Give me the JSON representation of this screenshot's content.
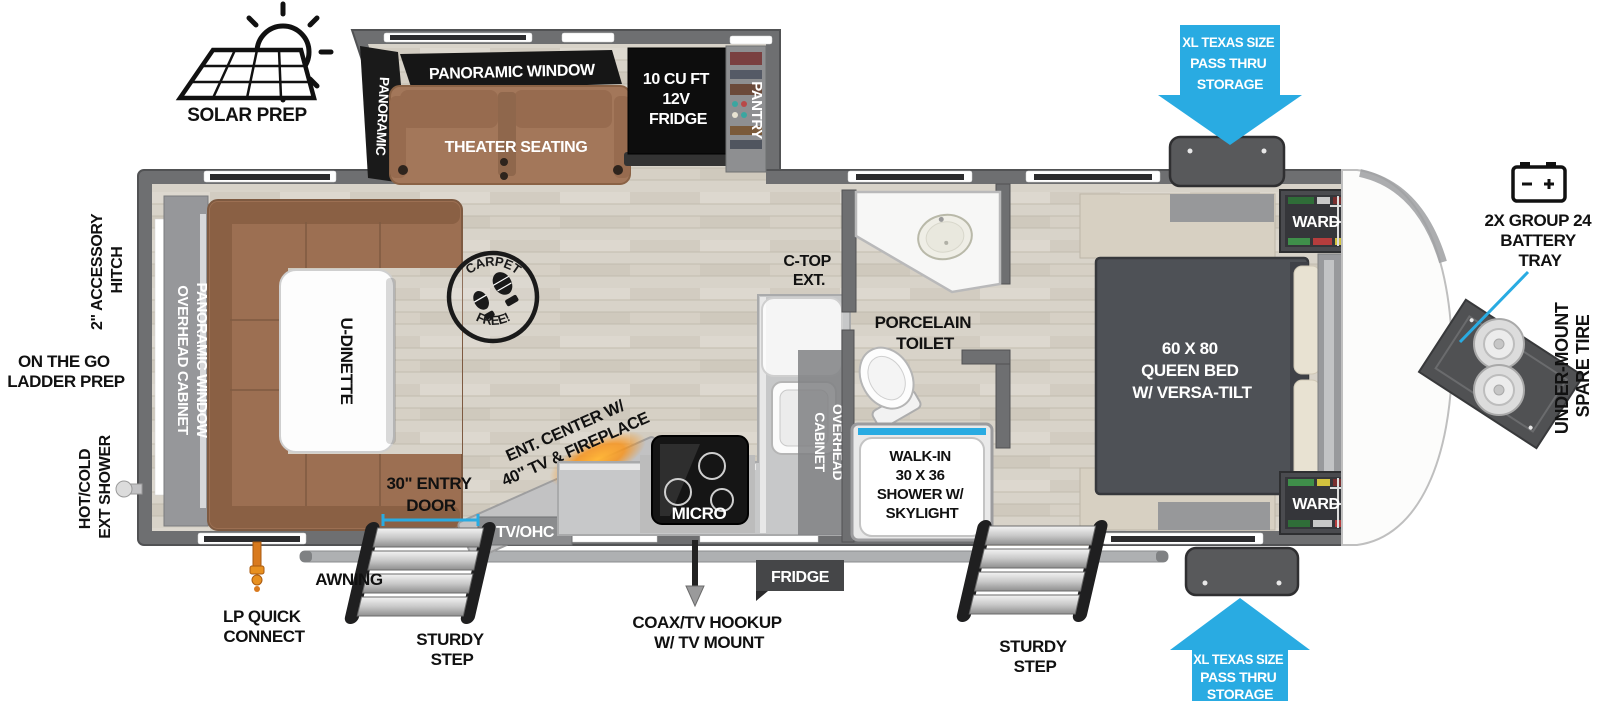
{
  "colors": {
    "accent_blue": "#29ABE2",
    "wall_gray": "#6E6F71",
    "sofa_brown": "#A3775A",
    "bed_gray": "#4E5156",
    "fireplace_orange": "#F7941D",
    "panel_black": "#111111"
  },
  "exterior": {
    "solar_prep_label": "SOLAR PREP",
    "pass_thru_top": [
      "XL TEXAS SIZE",
      "PASS THRU",
      "STORAGE"
    ],
    "pass_thru_bottom": [
      "XL TEXAS SIZE",
      "PASS THRU",
      "STORAGE"
    ],
    "battery_tray": [
      "2X GROUP 24",
      "BATTERY",
      "TRAY"
    ],
    "spare_tire": [
      "UNDER-MOUNT",
      "SPARE TIRE"
    ],
    "accessory_hitch": [
      "2\" ACCESSORY",
      "HITCH"
    ],
    "ladder_prep": [
      "ON THE GO",
      "LADDER PREP"
    ],
    "ext_shower": [
      "HOT/COLD",
      "EXT SHOWER"
    ],
    "lp_quick_connect": [
      "LP QUICK",
      "CONNECT"
    ],
    "awning": "AWNING",
    "sturdy_step_left": [
      "STURDY",
      "STEP"
    ],
    "sturdy_step_right": [
      "STURDY",
      "STEP"
    ],
    "coax_tv": [
      "COAX/TV HOOKUP",
      "W/ TV MOUNT"
    ],
    "fridge_exterior": "FRIDGE",
    "entry_door": [
      "30\" ENTRY",
      "DOOR"
    ]
  },
  "living_area": {
    "panoramic_window_angled": [
      "PANORAMIC",
      "WINDOW"
    ],
    "panoramic_window_banner": "PANORAMIC WINDOW",
    "theater_seating": "THEATER SEATING",
    "fridge_12v": [
      "10 CU FT",
      "12V",
      "FRIDGE"
    ],
    "pantry": "PANTRY",
    "overhead_cabinet_wall": "OVERHEAD CABINET",
    "panoramic_window_wall": "PANORAMIC WINDOW",
    "u_dinette": "U-DINETTE",
    "carpet_free": [
      "CARPET",
      "FREE!"
    ],
    "ent_center": [
      "ENT. CENTER W/",
      "40\" TV & FIREPLACE"
    ],
    "tv_ohc": "TV/OHC"
  },
  "kitchen": {
    "ctop_ext": [
      "C-TOP",
      "EXT."
    ],
    "overhead_cabinet": [
      "OVERHEAD",
      "CABINET"
    ],
    "micro": "MICRO"
  },
  "bathroom": {
    "porcelain_toilet": [
      "PORCELAIN",
      "TOILET"
    ],
    "shower": [
      "WALK-IN",
      "30 X 36",
      "SHOWER W/",
      "SKYLIGHT"
    ]
  },
  "bedroom": {
    "queen_bed": [
      "60 X 80",
      "QUEEN BED",
      "W/ VERSA-TILT"
    ],
    "overhead_cabinets": "OVERHEAD CABINETS",
    "ward_top": "WARD",
    "ward_bottom": "WARD"
  }
}
